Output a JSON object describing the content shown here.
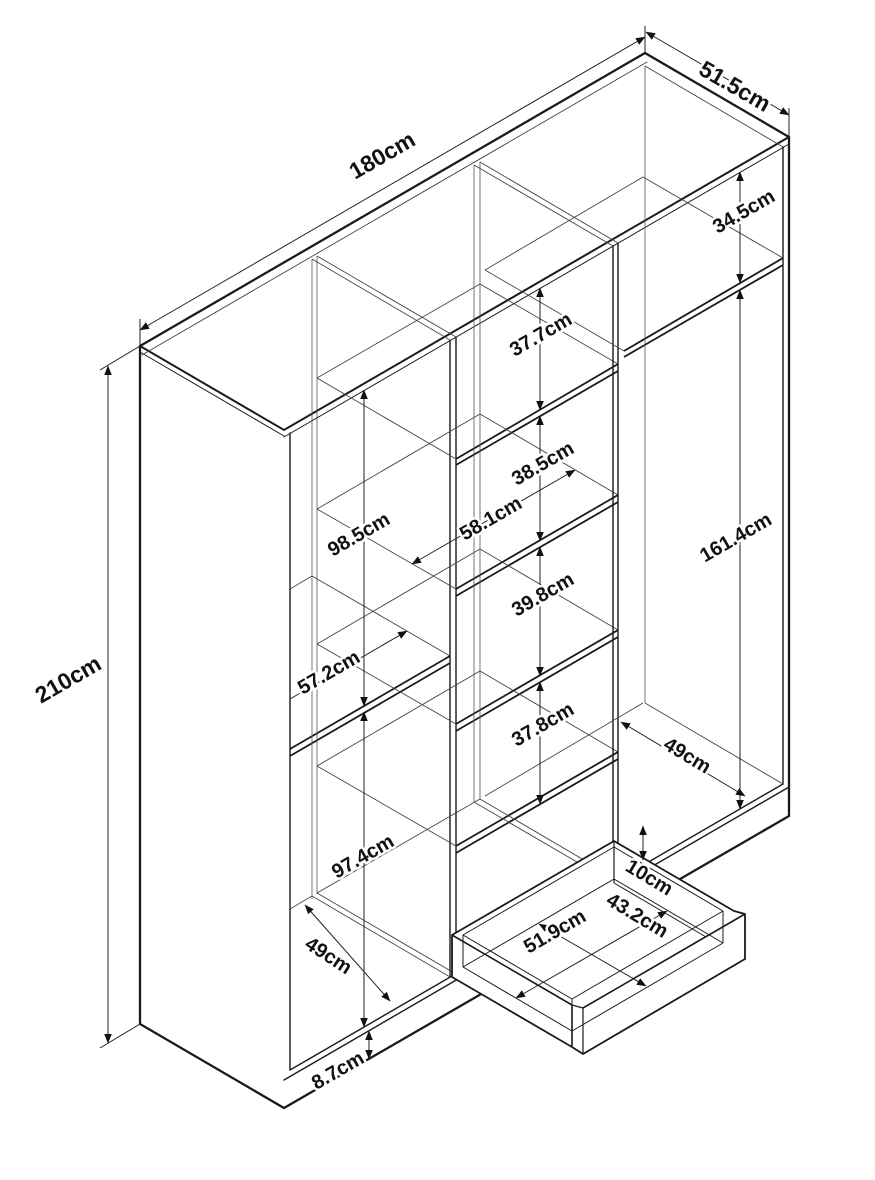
{
  "diagram": {
    "kind": "isometric furniture dimension drawing",
    "object": "wardrobe with shelves and pulled-out drawer",
    "unit": "cm",
    "line_color": "#1a1a1a",
    "background": "#ffffff",
    "overall": {
      "width": "180cm",
      "depth": "51.5cm",
      "height": "210cm"
    },
    "labels": {
      "w180": "180cm",
      "d51_5": "51.5cm",
      "h210": "210cm",
      "h34_5": "34.5cm",
      "h98_5": "98.5cm",
      "w57_2": "57.2cm",
      "h97_4": "97.4cm",
      "d49_left": "49cm",
      "h8_7": "8.7cm",
      "h37_7": "37.7cm",
      "h38_5": "38.5cm",
      "w58_1": "58.1cm",
      "h39_8": "39.8cm",
      "h37_8": "37.8cm",
      "h161_4": "161.4cm",
      "d49_right": "49cm",
      "h10": "10cm",
      "w51_9": "51.9cm",
      "d43_2": "43.2cm"
    }
  }
}
